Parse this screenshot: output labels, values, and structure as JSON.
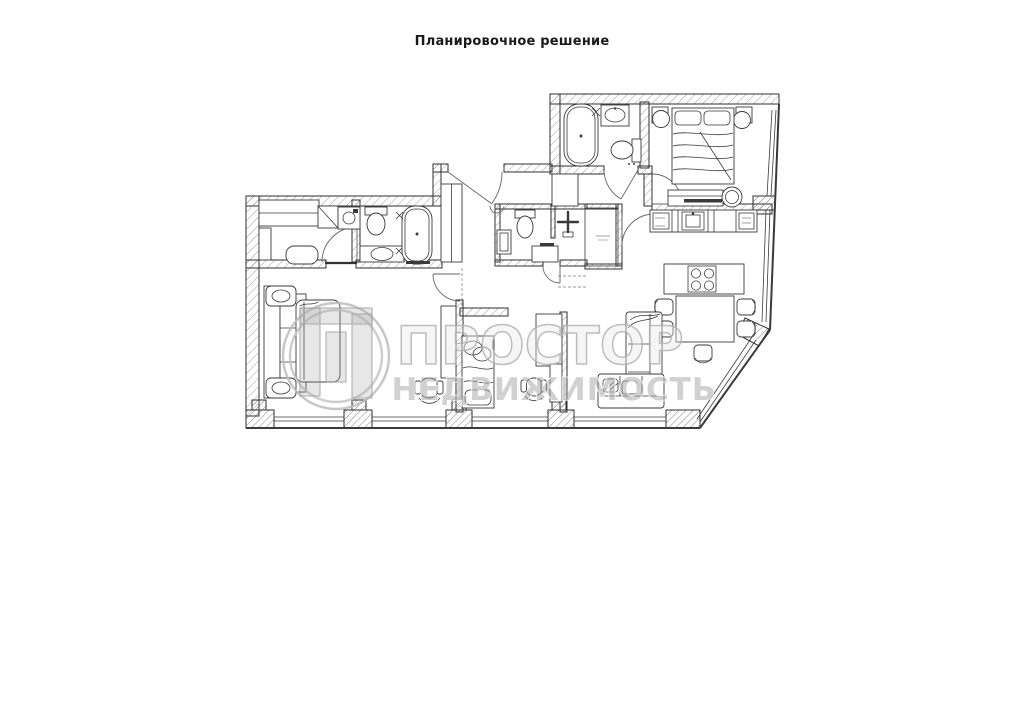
{
  "page": {
    "title": "Планировочное решение",
    "background": "#ffffff"
  },
  "watermark": {
    "brand": "ПРОСТОР",
    "tagline": "НЕДВИЖИМОСТЬ",
    "logo": "p-monogram-double-circle",
    "color": "#b5b5b5"
  },
  "drawing": {
    "type": "floor-plan",
    "ink_color": "#333333",
    "hatch_color": "#777777",
    "fixtures": [
      "bathtub-icon",
      "toilet-icon",
      "washbasin-icon",
      "shower-cross-icon",
      "double-bed-icon",
      "single-bed-icon",
      "nightstand-icon",
      "lamp-icon",
      "dresser-icon",
      "stool-icon",
      "sofa-icon",
      "corner-sofa-icon",
      "ottoman-icon",
      "desk-icon",
      "office-chair-icon",
      "dining-table-icon",
      "chair-icon",
      "cooktop-island-icon",
      "kitchen-counter-icon",
      "sink-unit-icon",
      "appliance-icon",
      "washing-machine-icon",
      "wardrobe-icon",
      "door-arc",
      "window-band"
    ]
  }
}
